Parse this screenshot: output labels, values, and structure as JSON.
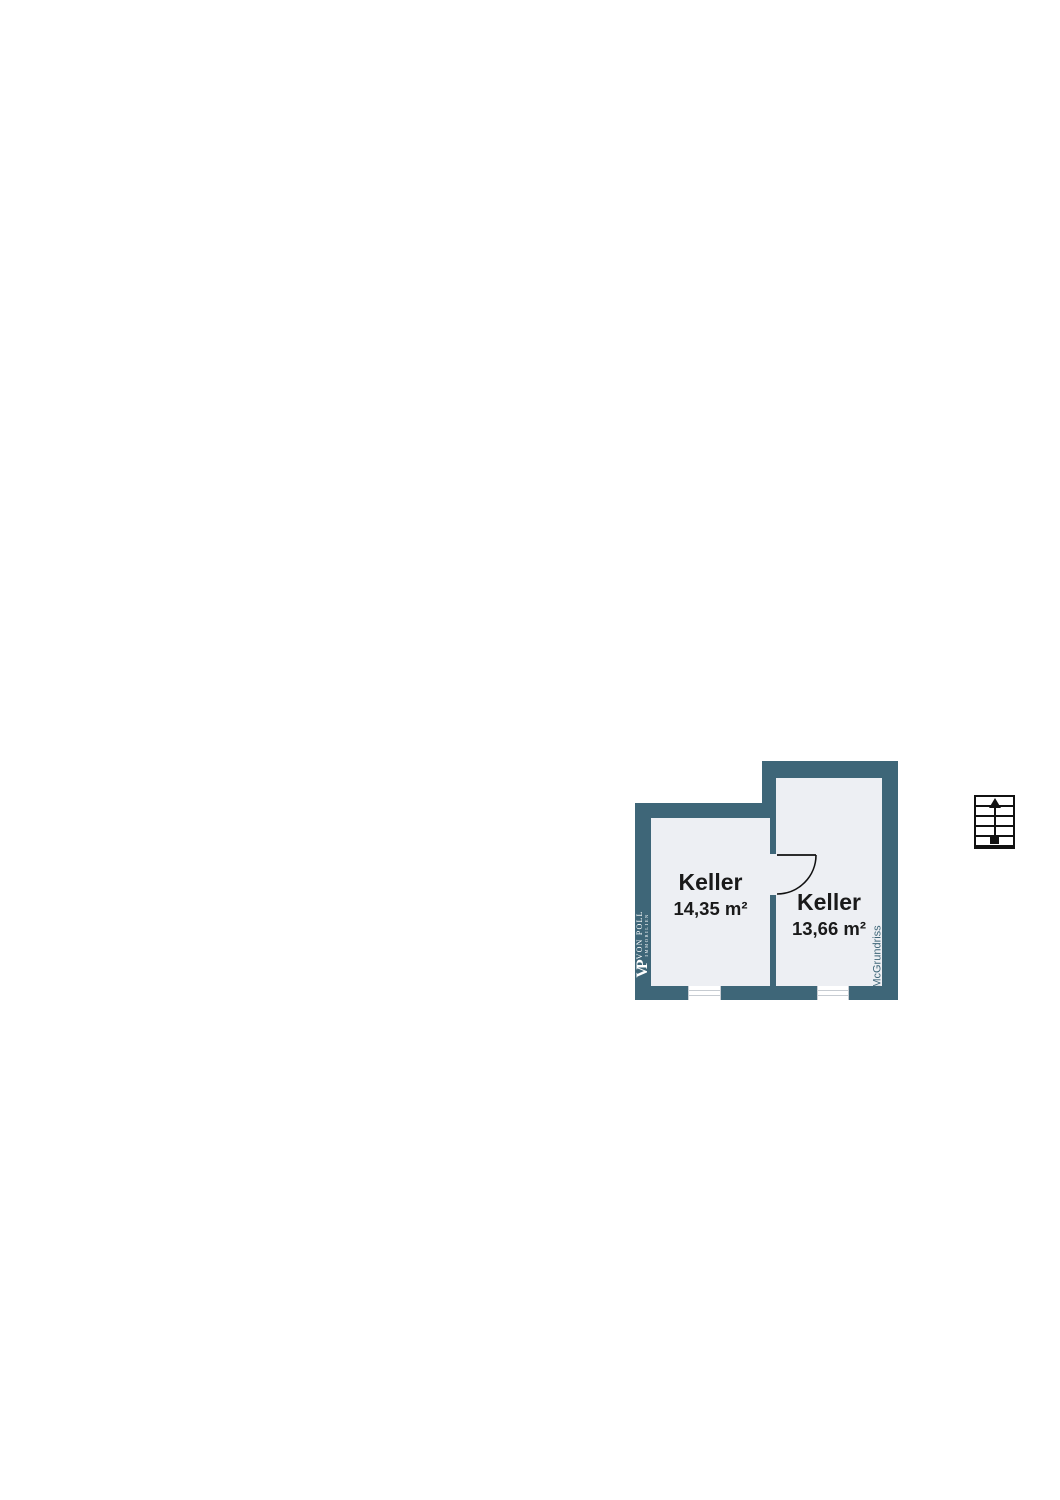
{
  "page": {
    "background": "#ffffff",
    "width": 1060,
    "height": 1500
  },
  "floorplan": {
    "rooms": [
      {
        "label": "Keller",
        "area": "14,35 m²"
      },
      {
        "label": "Keller",
        "area": "13,66 m²"
      }
    ],
    "branding": {
      "monogram": "VP",
      "name": "VON POLL",
      "suffix": "IMMOBILIEN",
      "watermark": "McGrundriss"
    },
    "icons": [
      "staircase-up-arrow-icon",
      "door-swing-arc-icon",
      "window-icon",
      "window-icon"
    ],
    "colors": {
      "wall": "#3e6678",
      "floor": "#edeff3",
      "label_text": "#1a1a1a",
      "watermark_text": "#3e6678",
      "ink": "#111111",
      "window_line": "#c7ccd2"
    }
  }
}
